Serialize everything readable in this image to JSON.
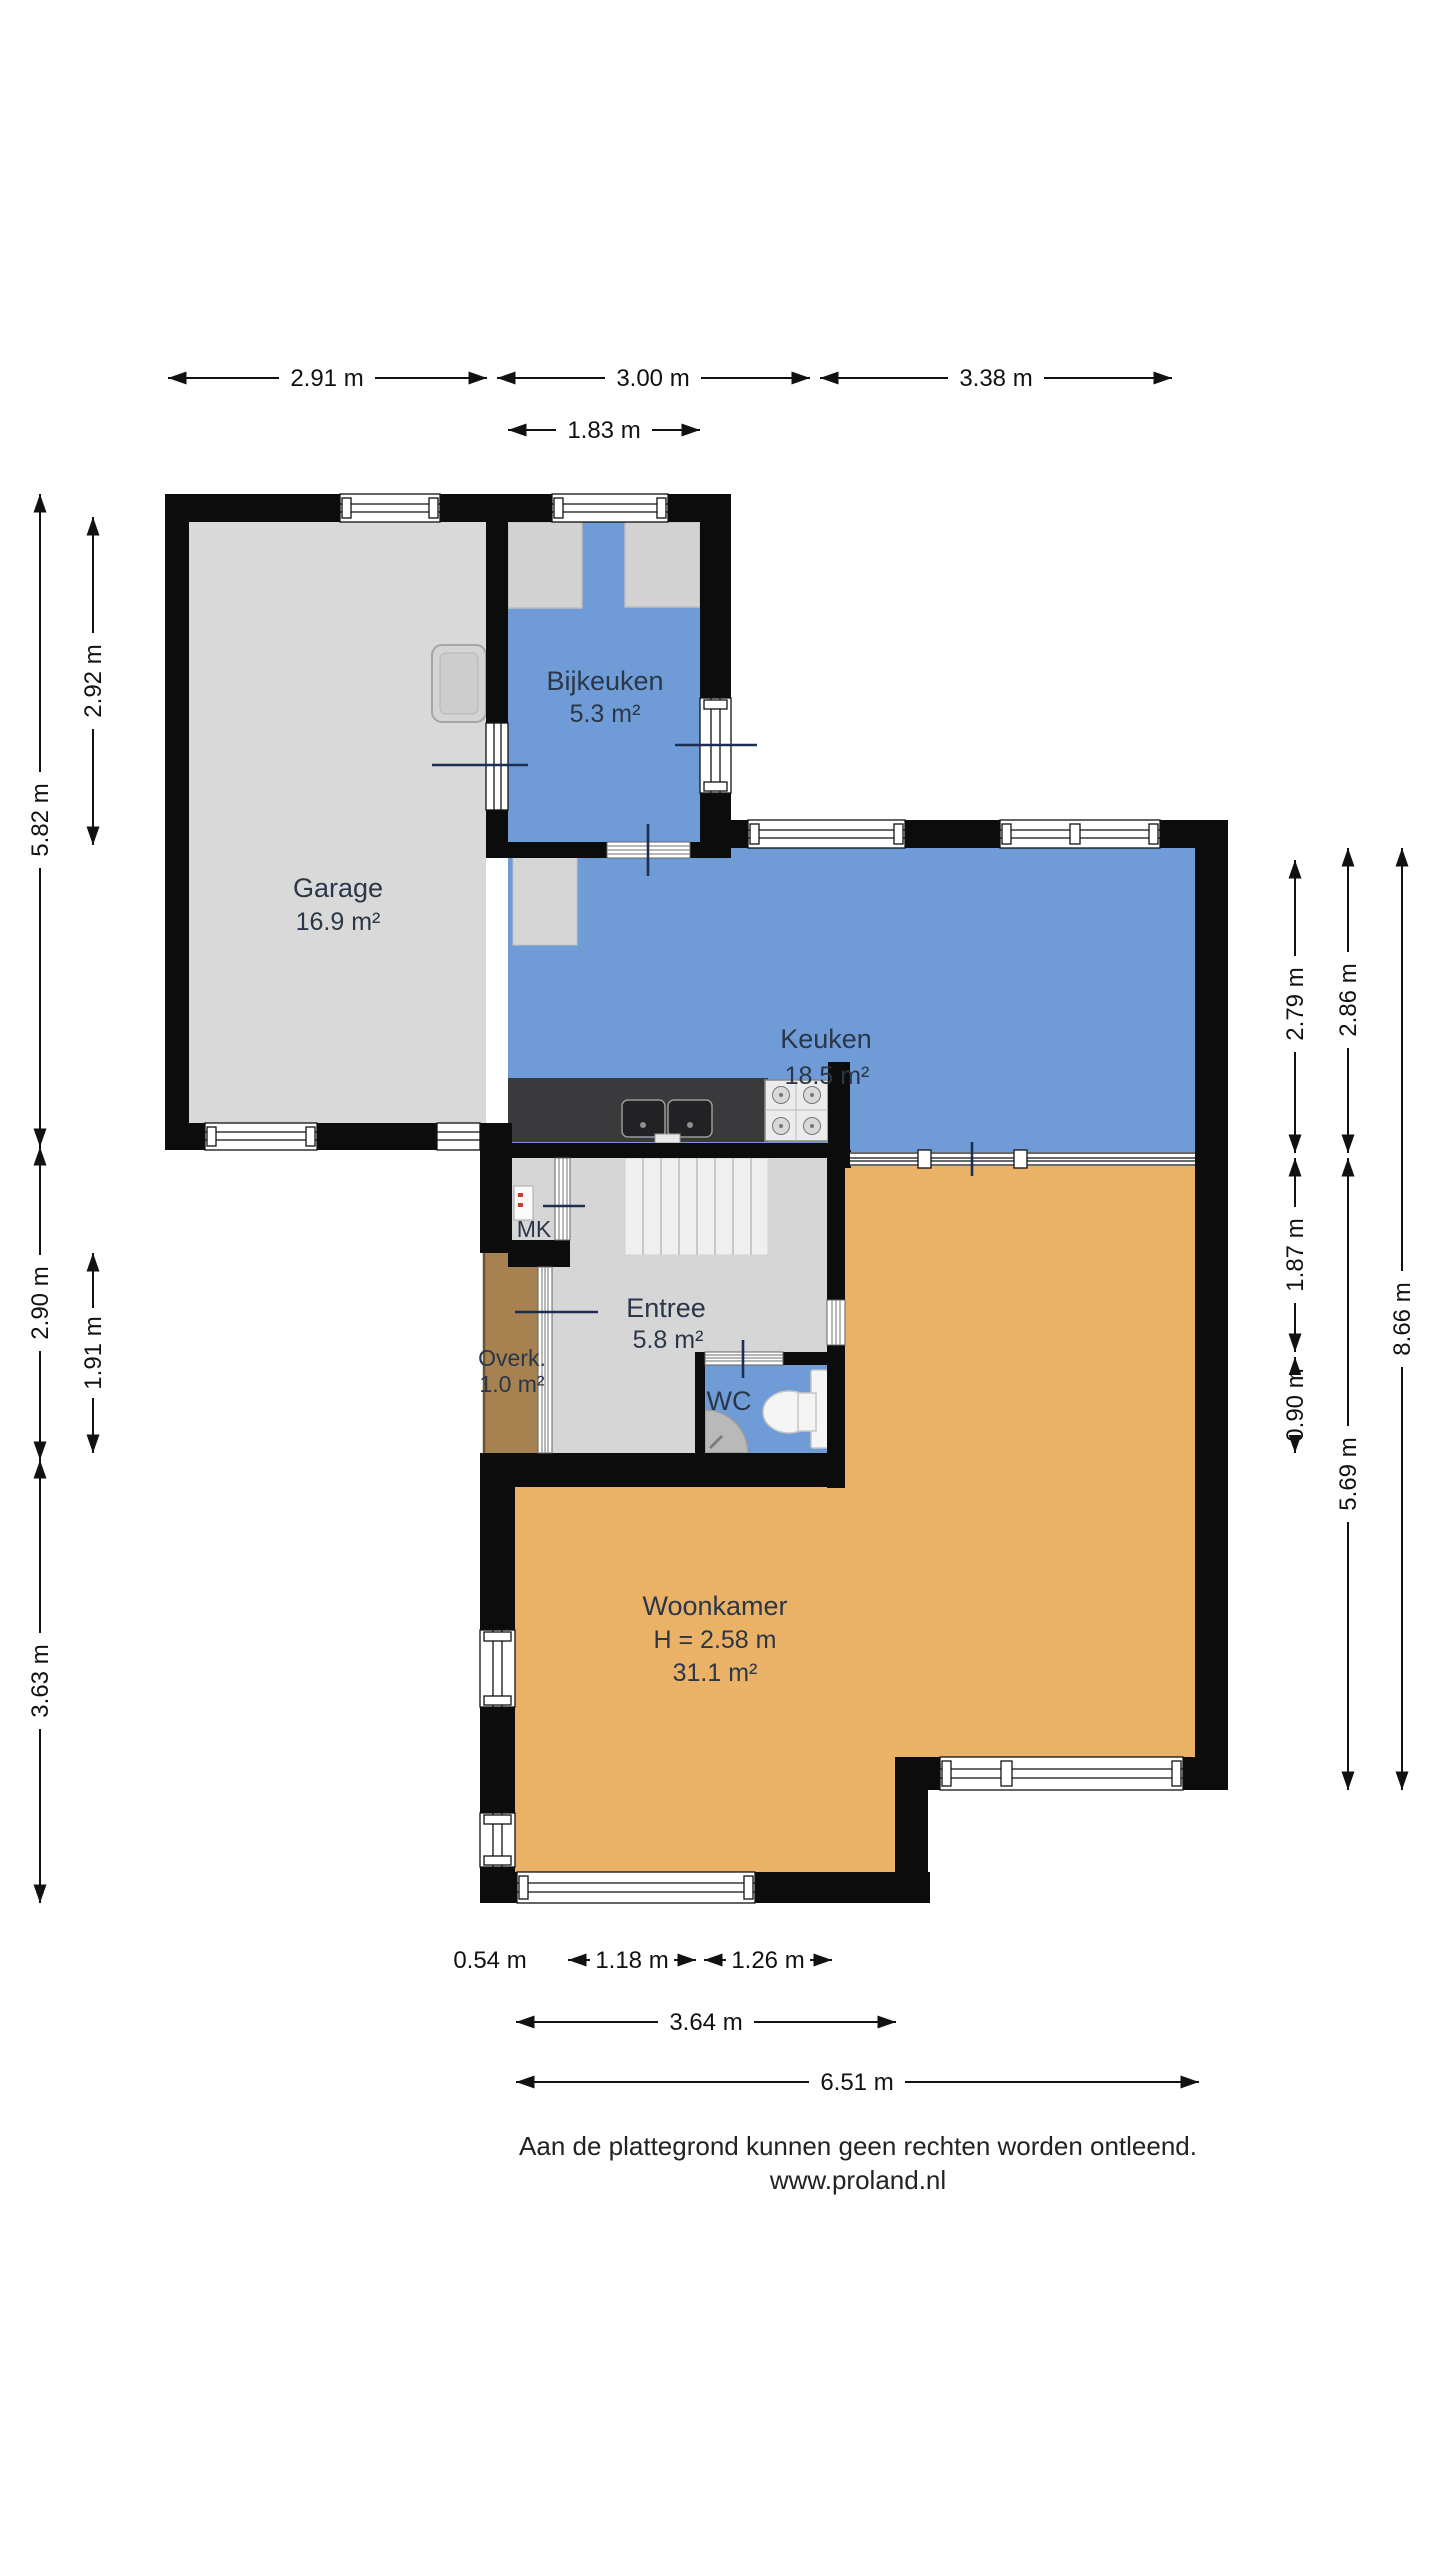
{
  "footer": {
    "line1": "Aan de plattegrond kunnen geen rechten worden ontleend.",
    "line2": "www.proland.nl"
  },
  "rooms": {
    "garage": {
      "name": "Garage",
      "area": "16.9 m²"
    },
    "bijkeuken": {
      "name": "Bijkeuken",
      "area": "5.3 m²"
    },
    "keuken": {
      "name": "Keuken",
      "area": "18.5 m²"
    },
    "mk": {
      "name": "MK"
    },
    "entree": {
      "name": "Entree",
      "area": "5.8 m²"
    },
    "overkapping": {
      "name": "Overk.",
      "area": "1.0 m²"
    },
    "wc": {
      "name": "WC"
    },
    "woonkamer": {
      "name": "Woonkamer",
      "ceiling_height": "H = 2.58 m",
      "area": "31.1 m²"
    }
  },
  "dimensions": {
    "top": [
      "2.91 m",
      "3.00 m",
      "3.38 m"
    ],
    "top2": [
      "1.83 m"
    ],
    "bottom1": [
      "0.54 m",
      "1.18 m",
      "1.26 m"
    ],
    "bottom2": [
      "3.64 m"
    ],
    "bottom3": [
      "6.51 m"
    ],
    "left_outer": [
      "5.82 m",
      "2.90 m",
      "3.63 m"
    ],
    "left_inner": [
      "2.92 m",
      "1.91 m"
    ],
    "right_inner": [
      "2.79 m",
      "1.87 m",
      "0.90 m"
    ],
    "right_mid": [
      "2.86 m",
      "5.69 m"
    ],
    "right_outer": [
      "8.66 m"
    ]
  },
  "colors": {
    "wall": "#0c0c0c",
    "wet_room": "#6f9cd6",
    "living": "#eab266",
    "garage_floor": "#d9d9d9",
    "entree_floor": "#d6d6d6",
    "overkapping": "#a5824f",
    "counter": "#3a3a3c",
    "dimension_text": "#111111",
    "label_text": "#2b3648"
  }
}
